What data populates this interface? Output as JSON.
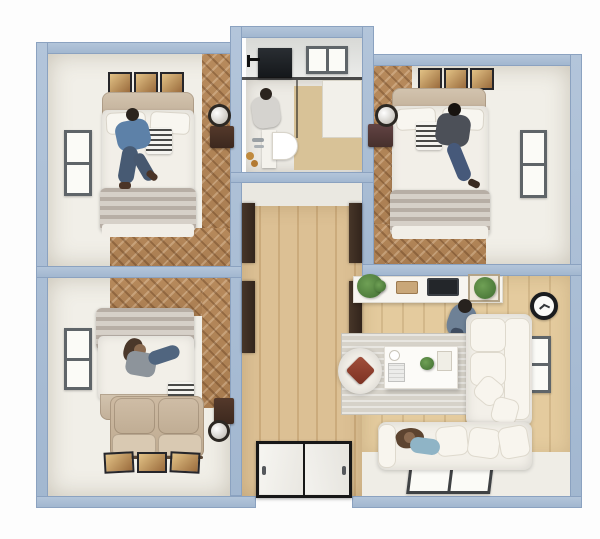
{
  "scene": {
    "title": "3D apartment floor plan, top-down view",
    "style": "photorealistic architectural render on white background",
    "people_count": 5,
    "layout": "two bedrooms on top, bathroom center-top, bedroom bottom-left, central hallway with entrance at bottom, living room bottom-right"
  },
  "rooms": [
    {
      "id": "bedroom-top-left",
      "label": "Bedroom",
      "items": [
        "double bed with white duvet and gray blanket",
        "man in blue shirt sitting on bed",
        "three framed artworks",
        "window on left wall",
        "dark nightstand",
        "round mirror",
        "herringbone wood floor strip"
      ]
    },
    {
      "id": "bathroom",
      "label": "Bathroom",
      "items": [
        "window on top wall",
        "dark wall cabinet",
        "black glass shower partition",
        "standing person",
        "white vanity with D-shaped basin",
        "chrome faucet",
        "amber toiletry bottles",
        "beige shower floor",
        "white side cabinet"
      ]
    },
    {
      "id": "bedroom-top-right",
      "label": "Bedroom",
      "items": [
        "double bed with white duvet and gray blanket",
        "man in dark shirt reading on bed",
        "three framed artworks",
        "window on right wall",
        "maroon nightstand",
        "round mirror",
        "herringbone wood floor strip"
      ]
    },
    {
      "id": "bedroom-bottom-left",
      "label": "Bedroom",
      "items": [
        "double bed with headboard at bottom",
        "woman in gray lying on bed",
        "beige two-seat loveseat",
        "three framed artworks",
        "window on left wall",
        "dark nightstand",
        "round mirror",
        "herringbone wood floor"
      ]
    },
    {
      "id": "hallway",
      "label": "Hallway",
      "items": [
        "light wood plank floor",
        "four dark open door panels",
        "double entrance door with black frame and two white leaves"
      ]
    },
    {
      "id": "living-room",
      "label": "Living room",
      "items": [
        "white TV console",
        "television",
        "potted plant left",
        "framed plant right",
        "standing man in gray-blue shirt",
        "black wall clock",
        "window on right wall",
        "L-shaped white sofa",
        "woman lying on sofa",
        "white coffee table with teapot, book, plant and tray",
        "round white pouf with red cushion",
        "gray rug",
        "flat window in bottom wall"
      ]
    }
  ],
  "palette": {
    "wall": "#a9bdd5",
    "wall_edge": "#8ba2c0",
    "floor_light": "#f1efe8",
    "wood_dark": "#b5885c",
    "wood_hall": "#dcc094",
    "wood_living": "#e4cb9e",
    "rug": "#d6d2c9",
    "sofa": "#f3f0e9",
    "accent_cushion": "#93402f",
    "tv": "#23262a",
    "plant": "#4c7d3c",
    "clock_rim": "#1a1c1e",
    "shower_floor": "#d8c297"
  }
}
